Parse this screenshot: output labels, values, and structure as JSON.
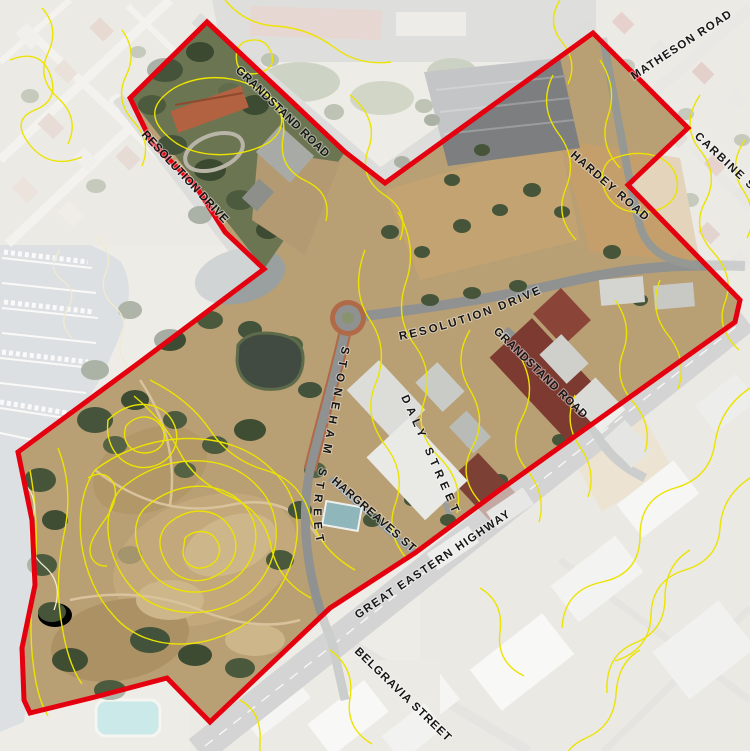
{
  "map": {
    "description": "Aerial site plan with red study-area boundary and yellow elevation contour lines",
    "boundary_color": "#e4000f",
    "contour_color": "#ece300",
    "water_color": "#b4bac0",
    "street_labels": [
      {
        "id": "matheson-road",
        "text": "MATHESON ROAD"
      },
      {
        "id": "carbine-street-clipped",
        "text": "CARBINE S"
      },
      {
        "id": "hardey-road",
        "text": "HARDEY ROAD"
      },
      {
        "id": "grandstand-road-north",
        "text": "GRANDSTAND ROAD"
      },
      {
        "id": "resolution-drive-west",
        "text": "RESOLUTION DRIVE"
      },
      {
        "id": "resolution-drive-central",
        "text": "RESOLUTION DRIVE"
      },
      {
        "id": "grandstand-road-central",
        "text": "GRANDSTAND ROAD"
      },
      {
        "id": "stoneham-street",
        "text": "STONEHAM STREET"
      },
      {
        "id": "daly-street",
        "text": "DALY STREET"
      },
      {
        "id": "hargreaves-street",
        "text": "HARGREAVES ST"
      },
      {
        "id": "great-eastern-highway",
        "text": "GREAT EASTERN HIGHWAY"
      },
      {
        "id": "belgravia-street",
        "text": "BELGRAVIA STREET"
      }
    ]
  }
}
